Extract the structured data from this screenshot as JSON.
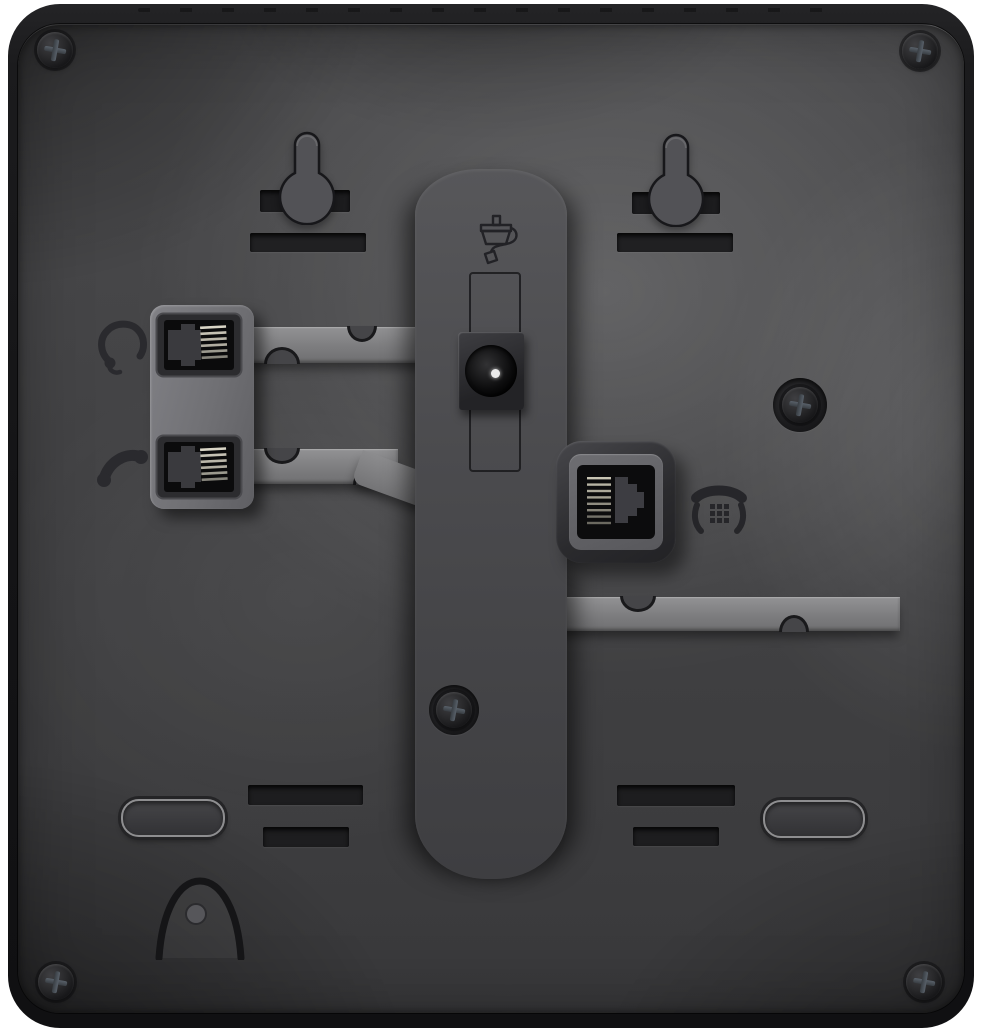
{
  "scene": {
    "type": "product-photo",
    "description": "Rear panel of a black desk IP phone on a white background, showing wall-mount keyholes, cable routing channels and connection ports",
    "background_color": "#ffffff"
  },
  "colors": {
    "page_bg": "#ffffff",
    "body_dark": "#161618",
    "panel_base": "#4a4a4c",
    "channel": "#4b4b4e",
    "strip": "#7d7d7f",
    "recess_dark": "#1d1d1f",
    "engraving": "#232327",
    "pin_highlight": "#ececec"
  },
  "ports": {
    "headset": {
      "label": "Headset port (RJ9)",
      "icon": "headset-icon"
    },
    "handset": {
      "label": "Handset port (RJ9)",
      "icon": "handset-icon"
    },
    "power": {
      "label": "DC power jack",
      "icon": "power-plug-icon"
    },
    "line": {
      "label": "Phone line / network port (RJ45)",
      "icon": "telephone-icon"
    }
  },
  "features": {
    "wall_mount_keyholes": 2,
    "keyhole_label": "Wall-mount keyhole slot",
    "corner_screws": 4,
    "panel_screws": 2,
    "stand_slots": 4,
    "rubber_feet": 2,
    "cable_channels": 3,
    "cable_hook_label": "Cable hook recess"
  }
}
